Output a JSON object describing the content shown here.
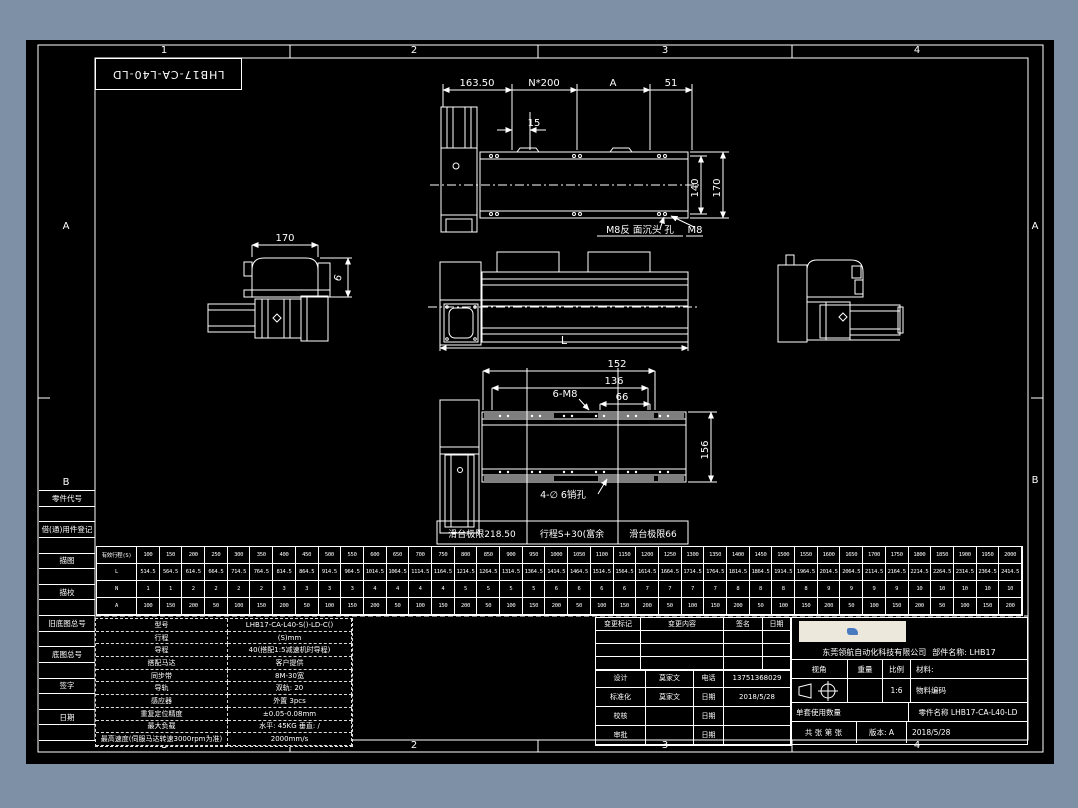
{
  "frame": {
    "zone_cols": [
      "1",
      "2",
      "3",
      "4"
    ],
    "zone_rows": [
      "A",
      "B"
    ],
    "corner_label": "LHB17-CA-L40-LD"
  },
  "left_fields": {
    "labels": [
      "零件代号",
      "借(通)用件登记",
      "描图",
      "描校",
      "旧底图总号",
      "底图总号",
      "签字",
      "日期"
    ]
  },
  "views": {
    "top_view": {
      "dim_163": "163.50",
      "dim_n200": "N*200",
      "dim_a": "A",
      "dim_51": "51",
      "dim_15": "15",
      "dim_140": "140",
      "dim_170": "170",
      "label_counterbore": "M8反 面沉头 孔",
      "label_m8": "M8"
    },
    "left_view": {
      "dim_170": "170",
      "dim_6": "6"
    },
    "front_view": {
      "dim_l": "L"
    },
    "bottom_view": {
      "dim_152": "152",
      "dim_136": "136",
      "dim_66": "66",
      "dim_156": "156",
      "label_6m8": "6-M8",
      "label_pin": "4-∅ 6销孔",
      "note_left": "滑台极限218.50",
      "note_mid": "行程S+30(富余",
      "note_right": "滑台极限66"
    }
  },
  "stroke_table": {
    "corner": "有效行程(S)",
    "rows": [
      "L",
      "N",
      "A"
    ],
    "S": [
      "100",
      "150",
      "200",
      "250",
      "300",
      "350",
      "400",
      "450",
      "500",
      "550",
      "600",
      "650",
      "700",
      "750",
      "800",
      "850",
      "900",
      "950",
      "1000",
      "1050",
      "1100",
      "1150",
      "1200",
      "1250",
      "1300",
      "1350",
      "1400",
      "1450",
      "1500",
      "1550",
      "1600",
      "1650",
      "1700",
      "1750",
      "1800",
      "1850",
      "1900",
      "1950",
      "2000"
    ],
    "L": [
      "514.5",
      "564.5",
      "614.5",
      "664.5",
      "714.5",
      "764.5",
      "814.5",
      "864.5",
      "914.5",
      "964.5",
      "1014.5",
      "1064.5",
      "1114.5",
      "1164.5",
      "1214.5",
      "1264.5",
      "1314.5",
      "1364.5",
      "1414.5",
      "1464.5",
      "1514.5",
      "1564.5",
      "1614.5",
      "1664.5",
      "1714.5",
      "1764.5",
      "1814.5",
      "1864.5",
      "1914.5",
      "1964.5",
      "2014.5",
      "2064.5",
      "2114.5",
      "2164.5",
      "2214.5",
      "2264.5",
      "2314.5",
      "2364.5",
      "2414.5"
    ],
    "N": [
      "1",
      "1",
      "2",
      "2",
      "2",
      "2",
      "3",
      "3",
      "3",
      "3",
      "4",
      "4",
      "4",
      "4",
      "5",
      "5",
      "5",
      "5",
      "6",
      "6",
      "6",
      "6",
      "7",
      "7",
      "7",
      "7",
      "8",
      "8",
      "8",
      "8",
      "9",
      "9",
      "9",
      "9",
      "10",
      "10",
      "10",
      "10",
      "10"
    ],
    "A": [
      "100",
      "150",
      "200",
      "50",
      "100",
      "150",
      "200",
      "50",
      "100",
      "150",
      "200",
      "50",
      "100",
      "150",
      "200",
      "50",
      "100",
      "150",
      "200",
      "50",
      "100",
      "150",
      "200",
      "50",
      "100",
      "150",
      "200",
      "50",
      "100",
      "150",
      "200",
      "50",
      "100",
      "150",
      "200",
      "50",
      "100",
      "150",
      "200"
    ]
  },
  "spec_table": {
    "rows": [
      [
        "型号",
        "LHB17-CA-L40-S()-LD-C()"
      ],
      [
        "行程",
        "(S)mm"
      ],
      [
        "导程",
        "40(搭配1:5减速机时导程)"
      ],
      [
        "搭配马达",
        "客户提供"
      ],
      [
        "同步带",
        "8M-30宽"
      ],
      [
        "导轨",
        "双轨: 20"
      ],
      [
        "感应器",
        "外置 3pcs"
      ],
      [
        "重复定位精度",
        "±0.05-0.08mm"
      ],
      [
        "最大负载",
        "水平: 45KG  垂直: /"
      ],
      [
        "最高速度(伺服马达转速3000rpm为准)",
        "2000mm/s"
      ]
    ]
  },
  "change_table": {
    "headers": [
      "变更标记",
      "变更内容",
      "签名",
      "日期"
    ],
    "empty_rows": 3,
    "sign_rows": [
      [
        "设计",
        "莫家文",
        "电话",
        "13751368029"
      ],
      [
        "标准化",
        "莫家文",
        "日期",
        "2018/5/28"
      ],
      [
        "校核",
        "",
        "日期",
        ""
      ],
      [
        "审批",
        "",
        "日期",
        ""
      ]
    ]
  },
  "title_block": {
    "company": "东莞领航自动化科技有限公司",
    "assembly": "部件名称: LHB17",
    "view_label": "视角",
    "weight_label": "重量",
    "scale_label": "比例",
    "scale_value": "1:6",
    "material_label": "材料:",
    "material_code": "物料编码",
    "qty_label": "单套使用数量",
    "part_name": "零件名称 LHB17-CA-L40-LD",
    "sheet_label": "共  张 第  张",
    "version": "版本: A",
    "date": "2018/5/28"
  }
}
